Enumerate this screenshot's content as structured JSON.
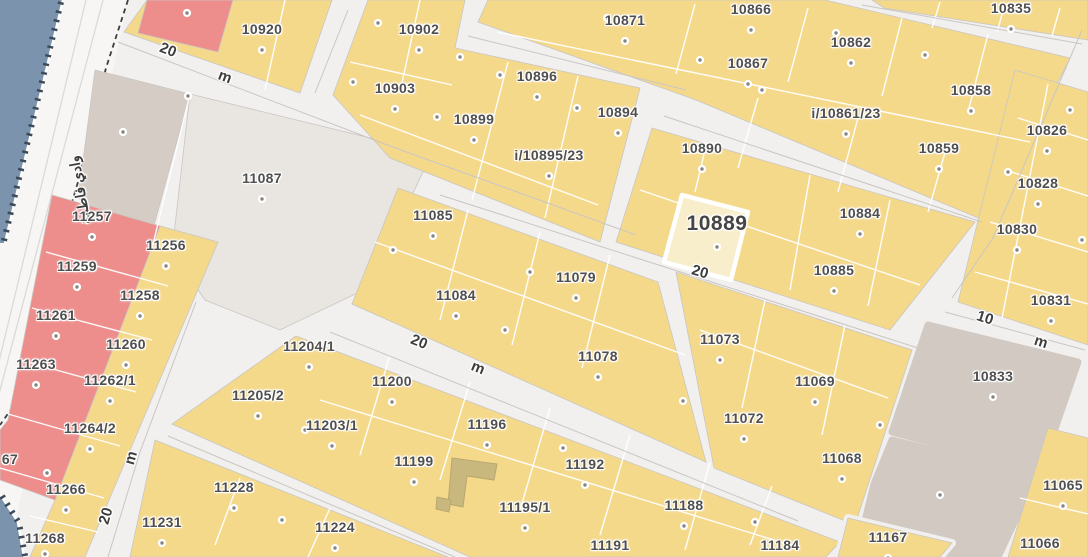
{
  "map": {
    "road_name_label": "وادي فاطمة",
    "highlighted_parcel": "10889",
    "colors": {
      "parcel_yellow": "#f5d98b",
      "parcel_pink": "#ed8e8c",
      "parcel_gray_light": "#e9e5e1",
      "parcel_gray": "#d1c9c2",
      "road": "#f1f0ef",
      "water_blue": "#7b93ac",
      "highlight_fill": "#f9eecb",
      "building": "#c9b87e",
      "label_text": "#4f4f4f",
      "street_label_text": "#3d3d3d"
    },
    "parcels": [
      {
        "label": "10920",
        "x": 262,
        "y": 29
      },
      {
        "label": "10902",
        "x": 419,
        "y": 29
      },
      {
        "label": "10871",
        "x": 625,
        "y": 20
      },
      {
        "label": "10866",
        "x": 751,
        "y": 9
      },
      {
        "label": "10835",
        "x": 1011,
        "y": 8
      },
      {
        "label": "10903",
        "x": 395,
        "y": 88
      },
      {
        "label": "10896",
        "x": 537,
        "y": 76
      },
      {
        "label": "10862",
        "x": 851,
        "y": 42
      },
      {
        "label": "10867",
        "x": 748,
        "y": 63
      },
      {
        "label": "10899",
        "x": 474,
        "y": 119
      },
      {
        "label": "10894",
        "x": 618,
        "y": 112
      },
      {
        "label": "i/10895/23",
        "x": 549,
        "y": 155
      },
      {
        "label": "i/10861/23",
        "x": 846,
        "y": 113
      },
      {
        "label": "10858",
        "x": 971,
        "y": 90
      },
      {
        "label": "10890",
        "x": 702,
        "y": 148
      },
      {
        "label": "10859",
        "x": 939,
        "y": 148
      },
      {
        "label": "10826",
        "x": 1047,
        "y": 130
      },
      {
        "label": "10828",
        "x": 1038,
        "y": 183
      },
      {
        "label": "11087",
        "x": 262,
        "y": 178
      },
      {
        "label": "11085",
        "x": 433,
        "y": 215
      },
      {
        "label": "10889",
        "x": 717,
        "y": 224,
        "big": true,
        "dy": 23
      },
      {
        "label": "10884",
        "x": 860,
        "y": 213
      },
      {
        "label": "10830",
        "x": 1017,
        "y": 229
      },
      {
        "label": "11257",
        "x": 92,
        "y": 216
      },
      {
        "label": "11256",
        "x": 166,
        "y": 245
      },
      {
        "label": "10885",
        "x": 834,
        "y": 270
      },
      {
        "label": "11259",
        "x": 77,
        "y": 266
      },
      {
        "label": "11258",
        "x": 140,
        "y": 295
      },
      {
        "label": "10831",
        "x": 1051,
        "y": 300
      },
      {
        "label": "11261",
        "x": 56,
        "y": 315
      },
      {
        "label": "11084",
        "x": 456,
        "y": 295
      },
      {
        "label": "11079",
        "x": 576,
        "y": 277
      },
      {
        "label": "11263",
        "x": 36,
        "y": 364
      },
      {
        "label": "11260",
        "x": 126,
        "y": 344
      },
      {
        "label": "11073",
        "x": 720,
        "y": 339
      },
      {
        "label": "11262/1",
        "x": 110,
        "y": 380
      },
      {
        "label": "11204/1",
        "x": 309,
        "y": 346
      },
      {
        "label": "11078",
        "x": 598,
        "y": 356
      },
      {
        "label": "11200",
        "x": 392,
        "y": 381
      },
      {
        "label": "10833",
        "x": 993,
        "y": 376
      },
      {
        "label": "11205/2",
        "x": 258,
        "y": 395
      },
      {
        "label": "11069",
        "x": 815,
        "y": 381
      },
      {
        "label": "11203/1",
        "x": 332,
        "y": 425
      },
      {
        "label": "11196",
        "x": 487,
        "y": 424
      },
      {
        "label": "11264/2",
        "x": 90,
        "y": 428
      },
      {
        "label": "11072",
        "x": 744,
        "y": 418
      },
      {
        "label": "11199",
        "x": 414,
        "y": 461
      },
      {
        "label": "11192",
        "x": 585,
        "y": 464
      },
      {
        "label": "11068",
        "x": 842,
        "y": 458
      },
      {
        "label": "67",
        "x": 10,
        "y": 459,
        "nodot": true
      },
      {
        "label": "11266",
        "x": 66,
        "y": 489
      },
      {
        "label": "11228",
        "x": 234,
        "y": 487
      },
      {
        "label": "11195/1",
        "x": 525,
        "y": 507
      },
      {
        "label": "11188",
        "x": 684,
        "y": 505
      },
      {
        "label": "11065",
        "x": 1063,
        "y": 485
      },
      {
        "label": "11231",
        "x": 162,
        "y": 522
      },
      {
        "label": "11268",
        "x": 45,
        "y": 538,
        "dy": 16
      },
      {
        "label": "11224",
        "x": 335,
        "y": 527
      },
      {
        "label": "11191",
        "x": 610,
        "y": 545
      },
      {
        "label": "11184",
        "x": 780,
        "y": 545
      },
      {
        "label": "11167",
        "x": 888,
        "y": 537
      },
      {
        "label": "11066",
        "x": 1040,
        "y": 543
      }
    ],
    "street_labels": [
      {
        "text": "20",
        "x": 168,
        "y": 50,
        "rot": 21
      },
      {
        "text": "m",
        "x": 225,
        "y": 77,
        "rot": 21
      },
      {
        "text": "20",
        "x": 700,
        "y": 272,
        "rot": 16
      },
      {
        "text": "20",
        "x": 419,
        "y": 342,
        "rot": 22
      },
      {
        "text": "m",
        "x": 478,
        "y": 368,
        "rot": 22
      },
      {
        "text": "10",
        "x": 985,
        "y": 318,
        "rot": 18
      },
      {
        "text": "m",
        "x": 1041,
        "y": 342,
        "rot": 18
      },
      {
        "text": "m",
        "x": 131,
        "y": 458,
        "rot": -74
      },
      {
        "text": "20",
        "x": 106,
        "y": 516,
        "rot": -74
      }
    ],
    "extra_dots": [
      [
        187,
        13
      ],
      [
        378,
        23
      ],
      [
        460,
        57
      ],
      [
        353,
        82
      ],
      [
        500,
        75
      ],
      [
        607,
        18
      ],
      [
        700,
        60
      ],
      [
        437,
        117
      ],
      [
        577,
        108
      ],
      [
        836,
        33
      ],
      [
        762,
        90
      ],
      [
        925,
        55
      ],
      [
        1008,
        172
      ],
      [
        1070,
        110
      ],
      [
        1082,
        240
      ],
      [
        123,
        132
      ],
      [
        188,
        96
      ],
      [
        393,
        250
      ],
      [
        530,
        272
      ],
      [
        505,
        330
      ],
      [
        683,
        401
      ],
      [
        880,
        425
      ],
      [
        563,
        448
      ],
      [
        305,
        430
      ],
      [
        755,
        522
      ],
      [
        940,
        495
      ],
      [
        47,
        473
      ],
      [
        282,
        520
      ]
    ]
  }
}
